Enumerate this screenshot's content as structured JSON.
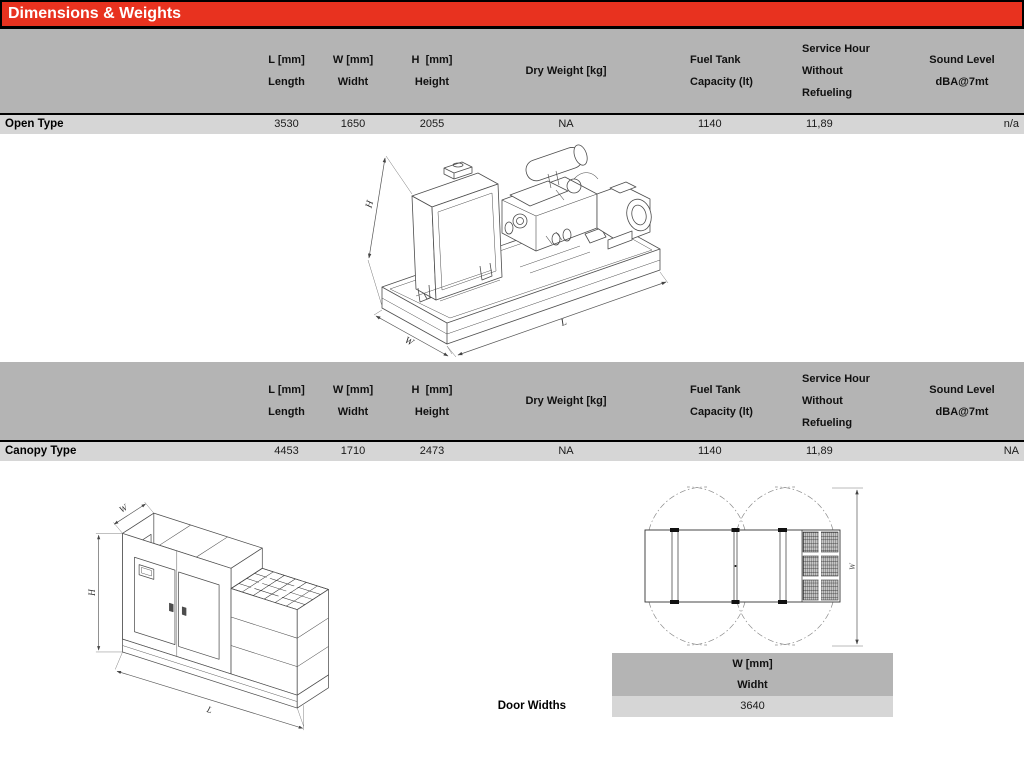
{
  "title_bar": {
    "title": "Dimensions & Weights"
  },
  "colors": {
    "accent_red": "#e8321f",
    "header_gray": "#b4b4b4",
    "row_gray": "#d6d6d6"
  },
  "columns": {
    "l1": "L [mm]",
    "l2": "Length",
    "w1": "W [mm]",
    "w2": "Widht",
    "h1": "H  [mm]",
    "h2": "Height",
    "dry": "Dry Weight [kg]",
    "fuel1": "Fuel Tank",
    "fuel2": "Capacity (lt)",
    "svc1": "Service Hour",
    "svc2": "Without",
    "svc3": "Refueling",
    "snd1": "Sound Level",
    "snd2": "dBA@7mt"
  },
  "rows": {
    "open": {
      "label": "Open Type",
      "l": "3530",
      "w": "1650",
      "h": "2055",
      "dry": "NA",
      "fuel": "1140",
      "service": "11,89",
      "sound": "n/a"
    },
    "canopy": {
      "label": "Canopy Type",
      "l": "4453",
      "w": "1710",
      "h": "2473",
      "dry": "NA",
      "fuel": "1140",
      "service": "11,89",
      "sound": "NA"
    }
  },
  "door_widths": {
    "label": "Door Widths",
    "h1": "W [mm]",
    "h2": "Widht",
    "value": "3640"
  },
  "drawings": {
    "open": {
      "h": "H",
      "l": "L",
      "w": "W"
    },
    "canopy": {
      "h": "H",
      "l": "L",
      "w": "W"
    },
    "plan": {
      "w": "W"
    }
  }
}
